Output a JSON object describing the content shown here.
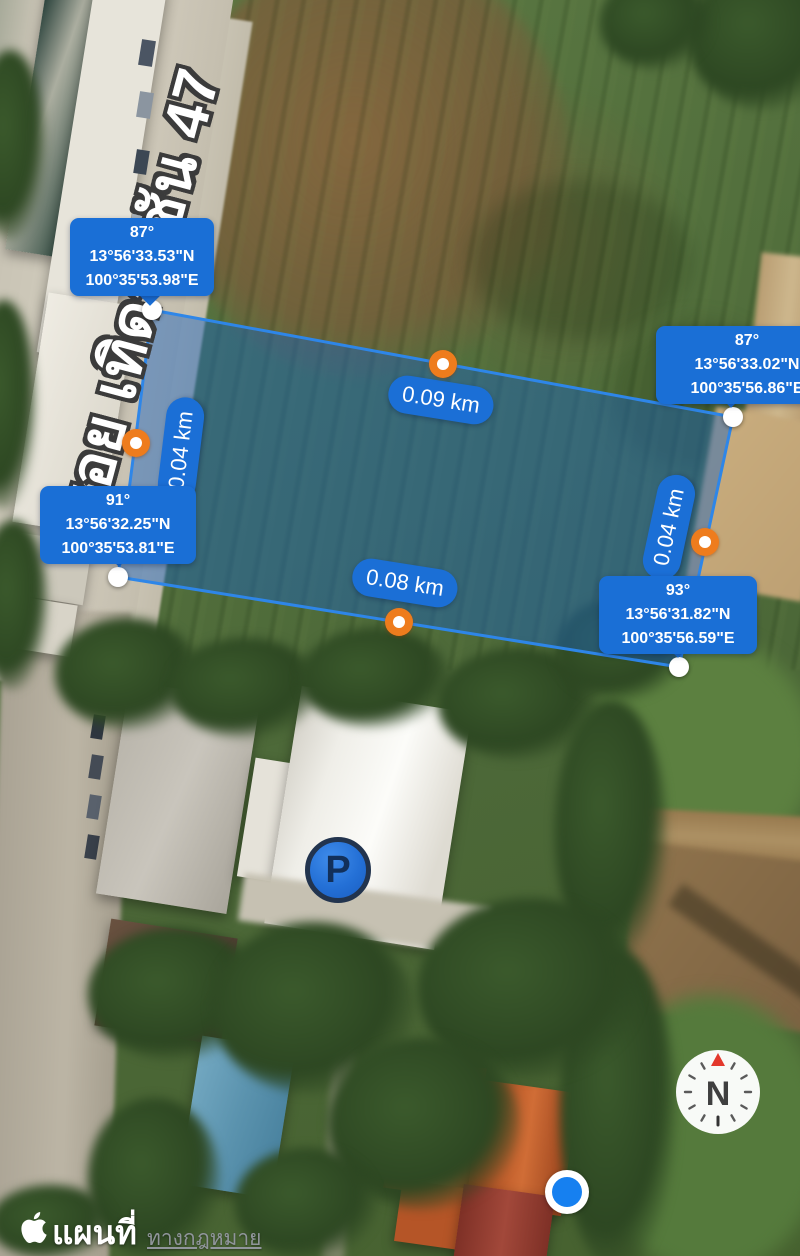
{
  "app": {
    "name": "แผนที่",
    "legal_label": "ทางกฎหมาย"
  },
  "map": {
    "street_label": "ซอย เทิดราชัน 47",
    "parking_marker": "P",
    "compass_north": "N"
  },
  "measurement": {
    "corners": [
      {
        "position": "top-left",
        "angle": "87°",
        "latitude": "13°56'33.53\"N",
        "longitude": "100°35'53.98\"E"
      },
      {
        "position": "top-right",
        "angle": "87°",
        "latitude": "13°56'33.02\"N",
        "longitude": "100°35'56.86\"E"
      },
      {
        "position": "bottom-left",
        "angle": "91°",
        "latitude": "13°56'32.25\"N",
        "longitude": "100°35'53.81\"E"
      },
      {
        "position": "bottom-right",
        "angle": "93°",
        "latitude": "13°56'31.82\"N",
        "longitude": "100°35'56.59\"E"
      }
    ],
    "sides": {
      "top": "0.09 km",
      "bottom": "0.08 km",
      "left": "0.04 km",
      "right": "0.04 km"
    }
  },
  "colors": {
    "callout_blue": "#1a6fd6",
    "polygon_fill": "rgba(25,98,190,0.45)",
    "polygon_stroke": "#2e86e8",
    "midpoint_orange": "#ee7c1d",
    "location_blue": "#1680f0",
    "compass_needle_red": "#e3382c"
  }
}
